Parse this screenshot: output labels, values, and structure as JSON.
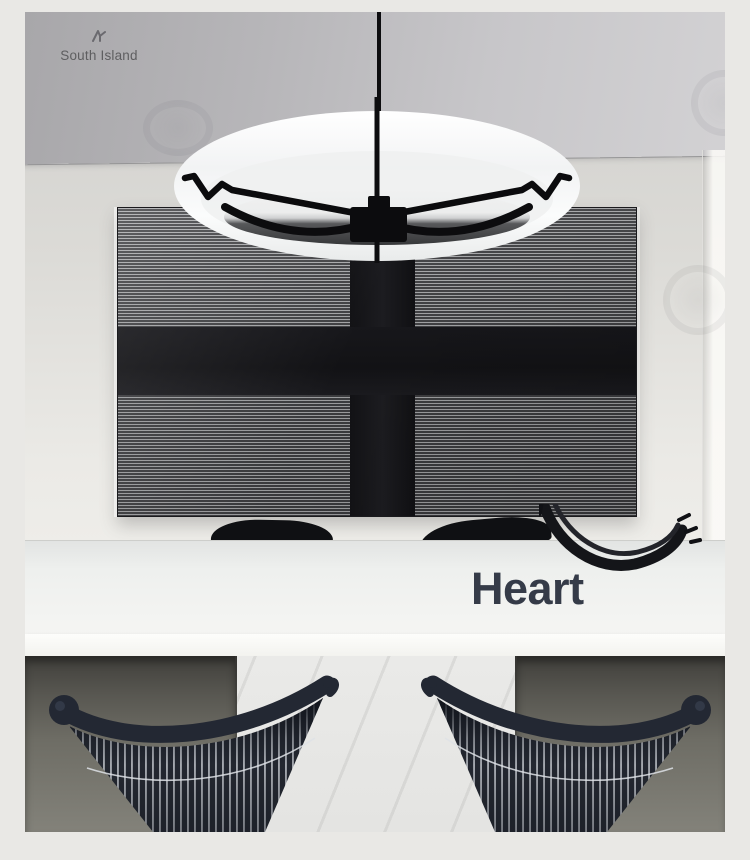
{
  "brand": {
    "name": "South Island",
    "icon": "brand-mark-icon",
    "text_color": "#5e5e60"
  },
  "caption": {
    "text": "Heart",
    "color": "#353b48"
  },
  "watermarks": {
    "style": "faint-circle-badges",
    "count": 4
  },
  "palette": {
    "page_margin": "#e9e8e5",
    "ceiling": "#b3b2b5",
    "wall": "#e4e3df",
    "art_panel_field": "#6f7072",
    "art_panel_cross": "#151518",
    "lamp_ring_white": "#f7f8f8",
    "lamp_hardware_black": "#0c0c0e",
    "table_white": "#f4f4f2",
    "alcove_shadow": "#55544d",
    "chair_body": "#232730",
    "chair_wire": "#c2c6cc"
  }
}
